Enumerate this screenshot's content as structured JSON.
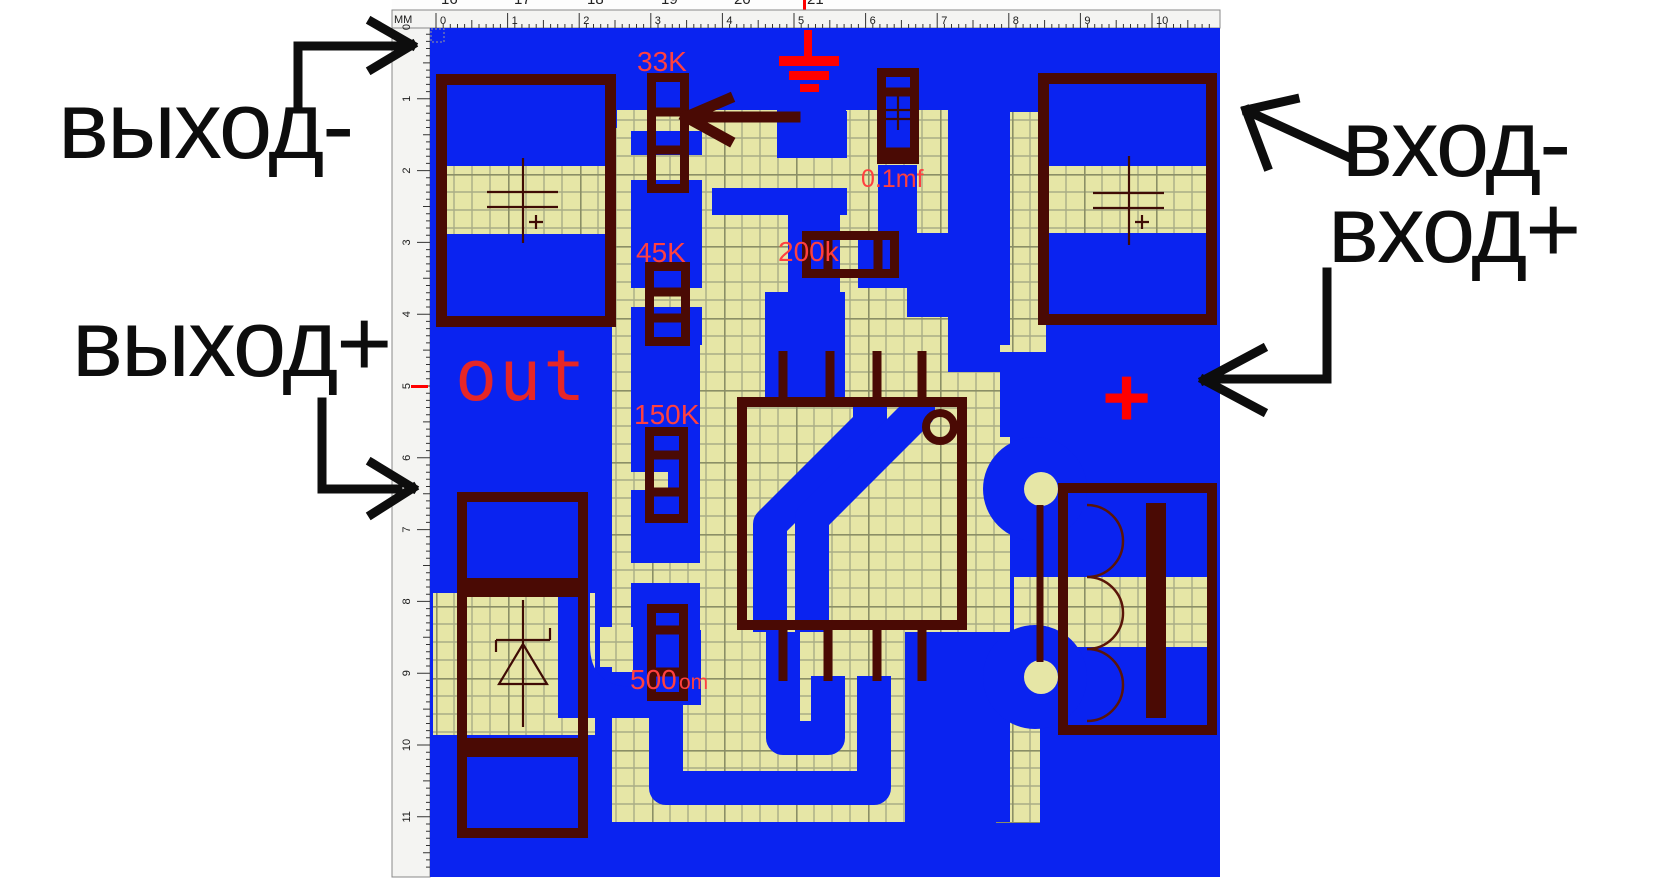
{
  "annotations": {
    "output_minus": "выход-",
    "output_plus": "выход+",
    "input_minus": "вход-",
    "input_plus": "вход+"
  },
  "board_labels": {
    "r_33k": "33K",
    "r_45k": "45K",
    "r_150k": "150K",
    "r_500_value": "500",
    "r_500_unit": "om",
    "r_200k": "200k",
    "c_01mf": "0.1mf",
    "out_label": "out",
    "plus_label": "+"
  },
  "rulers": {
    "unit_label": "MM",
    "top": {
      "origin": 436,
      "step": 71.6,
      "numbers": [
        "0",
        "1",
        "2",
        "3",
        "4",
        "5",
        "6",
        "7",
        "8",
        "9",
        "10"
      ]
    },
    "left": {
      "origin": 27,
      "step": 71.8,
      "numbers": [
        "0",
        "1",
        "2",
        "3",
        "4",
        "5",
        "6",
        "7",
        "8",
        "9",
        "10",
        "11"
      ]
    },
    "clipped_top": {
      "numbers": [
        "16",
        "17",
        "18",
        "19",
        "20",
        "21"
      ],
      "positions": [
        49,
        122,
        195,
        269,
        342,
        415
      ],
      "red_tick_x": 411
    }
  },
  "colors": {
    "copper_blue": "#0a23f0",
    "board_khaki": "#e6e6a6",
    "grid_line": "#a9ad86",
    "outline_maroon": "#4a0a04",
    "silkscreen_red": "#ff4040",
    "symbol_red": "#ff0000",
    "annotation_black": "#0d0d0d",
    "ruler_bg": "#f4f4f2"
  }
}
